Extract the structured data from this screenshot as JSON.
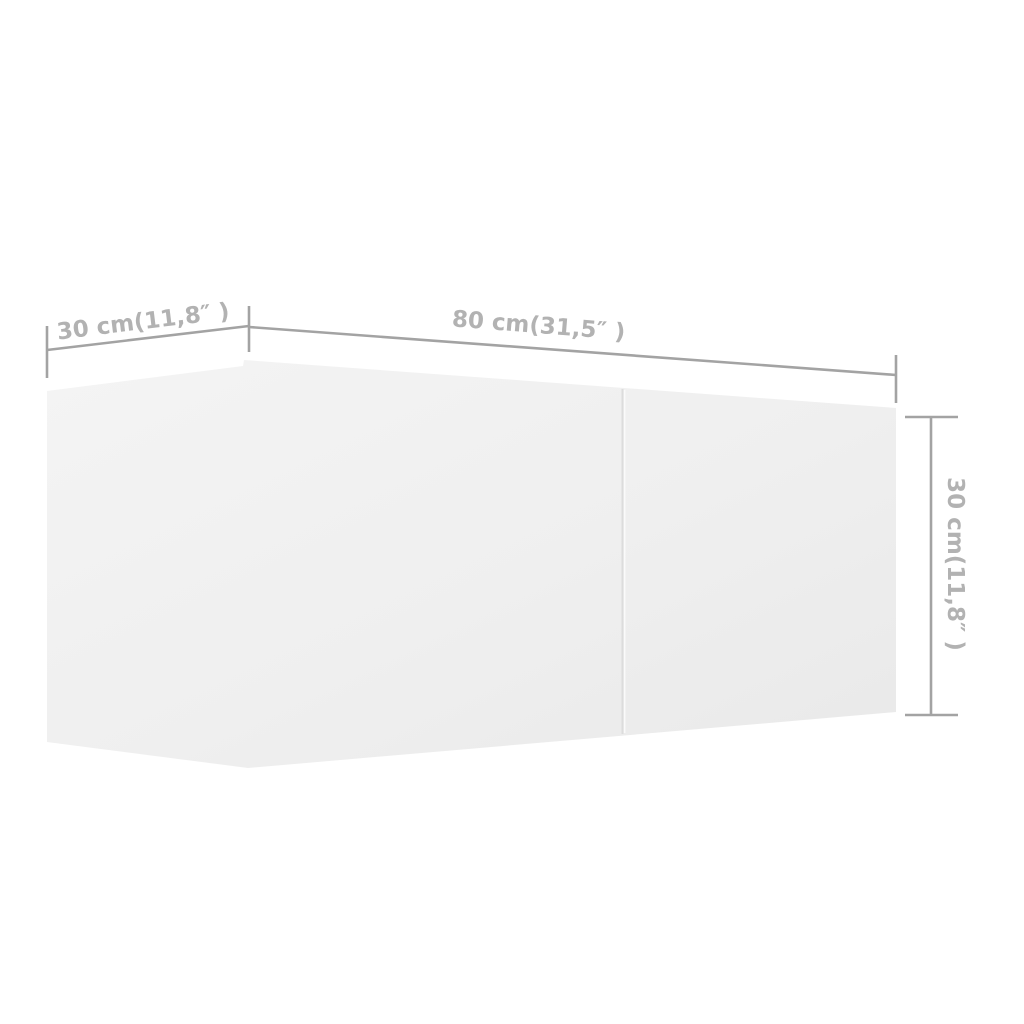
{
  "page": {
    "background": "#ffffff"
  },
  "figure": {
    "kind": "product-dimension-diagram",
    "colors": {
      "background": "#ffffff",
      "cabinet_fill_light": "#f4f4f4",
      "cabinet_fill": "#efefef",
      "cabinet_fill_dark": "#e9e9e9",
      "seam_line": "#dcdcdc",
      "seam_highlight": "#fafafa",
      "dimension_line": "#a3a3a3",
      "label_text": "#b2b2b2"
    },
    "dimensions": {
      "depth": {
        "label": "30 cm(11,8″ )",
        "value": "30",
        "unit": "cm",
        "inches": "11,8″"
      },
      "width": {
        "label": "80 cm(31,5″ )",
        "value": "80",
        "unit": "cm",
        "inches": "31,5″"
      },
      "height": {
        "label": "30 cm(11,8″ )",
        "value": "30",
        "unit": "cm",
        "inches": "11,8″"
      }
    }
  }
}
